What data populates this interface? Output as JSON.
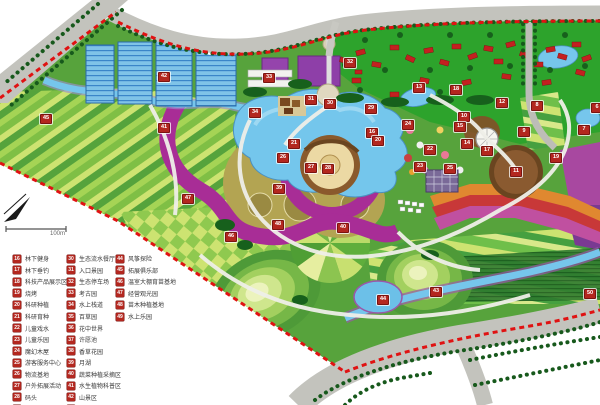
{
  "map": {
    "title": "生态农业观光园总平面图",
    "scale_label": "100m",
    "colors": {
      "border_dash_red": "#e01212",
      "marker_red": "#b3271f",
      "road_gray": "#c3c3bd",
      "water_blue": "#76c6ec",
      "village_green": "#2da32c",
      "base_green": "#57a33c",
      "field_stripe_light": "#cde371",
      "field_stripe_dark": "#7fbf45",
      "flower_magenta": "#a82d96",
      "building_purple": "#8e3fa8",
      "plaza_tan": "#ecd9a4",
      "greenhouse_blue": "#7fc3e8",
      "building_red": "#c42020"
    },
    "markers": [
      {
        "n": "42",
        "x": 163,
        "y": 76
      },
      {
        "n": "45",
        "x": 45,
        "y": 118
      },
      {
        "n": "41",
        "x": 163,
        "y": 127
      },
      {
        "n": "47",
        "x": 187,
        "y": 198
      },
      {
        "n": "33",
        "x": 268,
        "y": 77
      },
      {
        "n": "34",
        "x": 254,
        "y": 112
      },
      {
        "n": "32",
        "x": 349,
        "y": 62
      },
      {
        "n": "31",
        "x": 310,
        "y": 99
      },
      {
        "n": "30",
        "x": 329,
        "y": 103
      },
      {
        "n": "29",
        "x": 370,
        "y": 108
      },
      {
        "n": "13",
        "x": 418,
        "y": 87
      },
      {
        "n": "18",
        "x": 455,
        "y": 89
      },
      {
        "n": "12",
        "x": 501,
        "y": 102
      },
      {
        "n": "8",
        "x": 536,
        "y": 105
      },
      {
        "n": "6",
        "x": 596,
        "y": 107
      },
      {
        "n": "10",
        "x": 463,
        "y": 116
      },
      {
        "n": "24",
        "x": 407,
        "y": 124
      },
      {
        "n": "9",
        "x": 523,
        "y": 131
      },
      {
        "n": "7",
        "x": 583,
        "y": 129
      },
      {
        "n": "16",
        "x": 371,
        "y": 132
      },
      {
        "n": "20",
        "x": 377,
        "y": 140
      },
      {
        "n": "21",
        "x": 293,
        "y": 143
      },
      {
        "n": "14",
        "x": 466,
        "y": 143
      },
      {
        "n": "22",
        "x": 429,
        "y": 149
      },
      {
        "n": "17",
        "x": 486,
        "y": 150
      },
      {
        "n": "19",
        "x": 555,
        "y": 157
      },
      {
        "n": "26",
        "x": 282,
        "y": 157
      },
      {
        "n": "23",
        "x": 419,
        "y": 166
      },
      {
        "n": "27",
        "x": 310,
        "y": 167
      },
      {
        "n": "28",
        "x": 327,
        "y": 168
      },
      {
        "n": "25",
        "x": 449,
        "y": 168
      },
      {
        "n": "11",
        "x": 515,
        "y": 171
      },
      {
        "n": "15",
        "x": 459,
        "y": 126
      },
      {
        "n": "39",
        "x": 278,
        "y": 188
      },
      {
        "n": "48",
        "x": 277,
        "y": 224
      },
      {
        "n": "40",
        "x": 342,
        "y": 227
      },
      {
        "n": "46",
        "x": 230,
        "y": 236
      },
      {
        "n": "43",
        "x": 435,
        "y": 291
      },
      {
        "n": "44",
        "x": 382,
        "y": 299
      },
      {
        "n": "50",
        "x": 589,
        "y": 293
      }
    ]
  },
  "legend": {
    "columns": [
      {
        "left": 13,
        "items": [
          {
            "num": "16",
            "label": "林下健身"
          },
          {
            "num": "17",
            "label": "林下垂钓"
          },
          {
            "num": "18",
            "label": "科技产品展示区"
          },
          {
            "num": "19",
            "label": "烧烤"
          },
          {
            "num": "20",
            "label": "科研种植"
          },
          {
            "num": "21",
            "label": "科研育种"
          },
          {
            "num": "22",
            "label": "儿童戏水"
          },
          {
            "num": "23",
            "label": "儿童乐园"
          },
          {
            "num": "24",
            "label": "魔幻木屋"
          },
          {
            "num": "25",
            "label": "游客服务中心"
          },
          {
            "num": "26",
            "label": "物流基地"
          },
          {
            "num": "27",
            "label": "户外拓展活动"
          },
          {
            "num": "28",
            "label": "码头"
          },
          {
            "num": "29",
            "label": "荷塘游船"
          }
        ]
      },
      {
        "left": 67,
        "items": [
          {
            "num": "30",
            "label": "生态流水餐厅"
          },
          {
            "num": "31",
            "label": "入口景园"
          },
          {
            "num": "32",
            "label": "生态停车场"
          },
          {
            "num": "33",
            "label": "考古园"
          },
          {
            "num": "34",
            "label": "水上栈道"
          },
          {
            "num": "35",
            "label": "百草园"
          },
          {
            "num": "36",
            "label": "花中世界"
          },
          {
            "num": "37",
            "label": "许愿池"
          },
          {
            "num": "38",
            "label": "香草花园"
          },
          {
            "num": "39",
            "label": "月湖"
          },
          {
            "num": "40",
            "label": "蔬菜种植采摘区"
          },
          {
            "num": "41",
            "label": "水生植物科普区"
          },
          {
            "num": "42",
            "label": "山景区"
          },
          {
            "num": "43",
            "label": "木栈道"
          }
        ]
      },
      {
        "left": 116,
        "items": [
          {
            "num": "44",
            "label": "风筝探险"
          },
          {
            "num": "45",
            "label": "拓展俱乐部"
          },
          {
            "num": "46",
            "label": "温室大棚育苗基地"
          },
          {
            "num": "47",
            "label": "经营观光园"
          },
          {
            "num": "48",
            "label": "苗木种植基地"
          },
          {
            "num": "49",
            "label": "水上乐园"
          }
        ]
      }
    ]
  }
}
